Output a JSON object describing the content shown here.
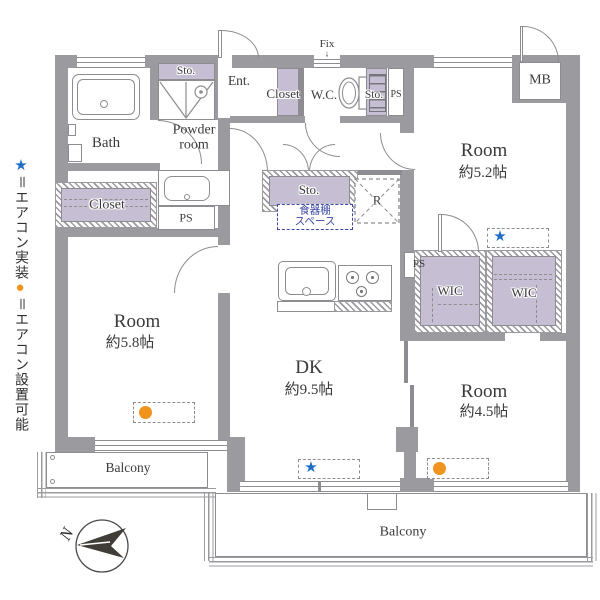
{
  "palette": {
    "wall_gray": "#9b9a9f",
    "storage_fill_purple": "#c6bfd3",
    "cupboard_blue": "#3b49a5",
    "aircon_star_blue": "#1e6ec8",
    "aircon_dot_orange": "#f0941d"
  },
  "legend": {
    "star_symbol": "★",
    "star_text": "＝エアコン実装",
    "dot_symbol": "●",
    "dot_text": "＝エアコン設置可能"
  },
  "compass": {
    "north": "N"
  },
  "labels": {
    "bath": "Bath",
    "powder_room": "Powder room",
    "laundry_storage": "Sto.",
    "closet_left": "Closet",
    "ps_left": "PS",
    "entrance": "Ent.",
    "closet_hall": "Closet",
    "wc": "W.C.",
    "storage_hall": "Sto.",
    "ps_hall": "PS",
    "fix": "Fix",
    "fix_arrow": "↓",
    "meter_box": "MB",
    "storage_center": "Sto.",
    "cupboard_line1": "食器棚",
    "cupboard_line2": "スペース",
    "refrigerator": "R",
    "dk_name": "DK",
    "dk_size": "約9.5帖",
    "room52_name": "Room",
    "room52_size": "約5.2帖",
    "room58_name": "Room",
    "room58_size": "約5.8帖",
    "room45_name": "Room",
    "room45_size": "約4.5帖",
    "ps_right": "PS",
    "wic_left": "WIC",
    "wic_right": "WIC",
    "balcony_left": "Balcony",
    "balcony_bottom": "Balcony",
    "aircon_installed": "★"
  }
}
